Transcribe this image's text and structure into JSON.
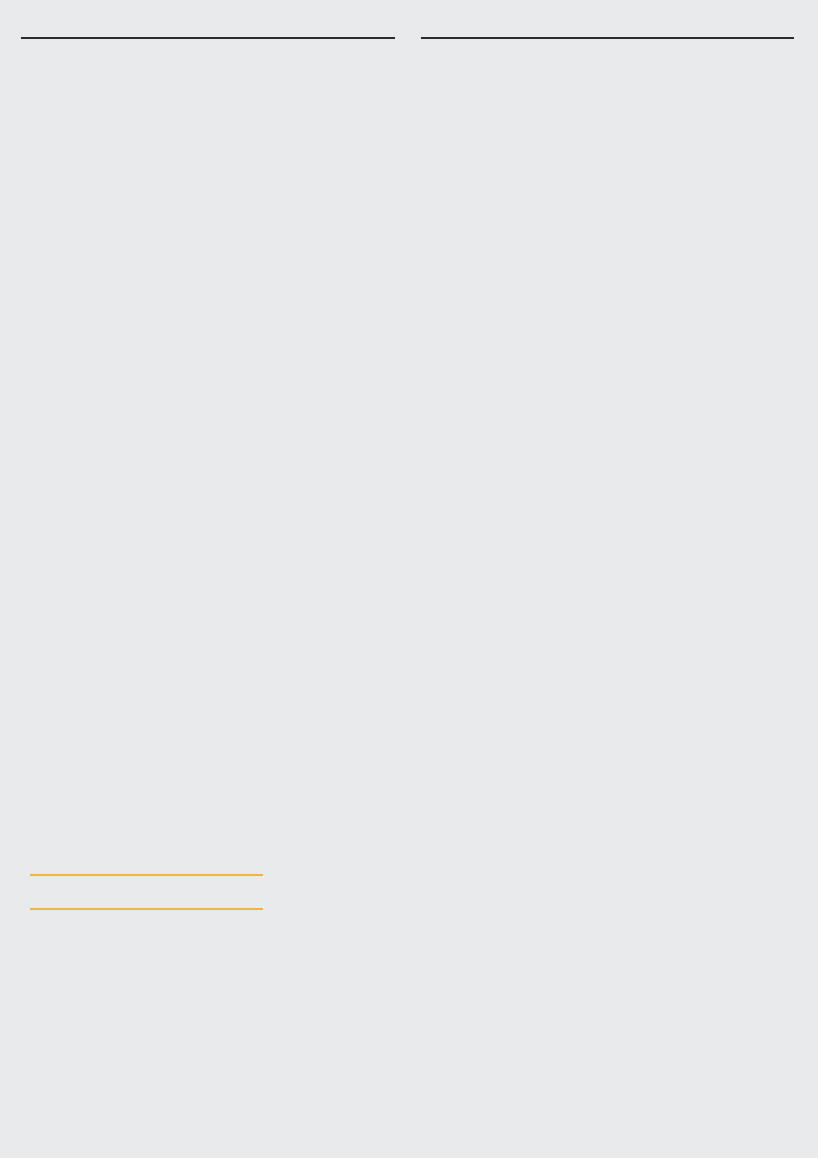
{
  "header": {
    "brand": "ROOF VAZISUBANI"
  },
  "title": "93.9 მ² რენდერი",
  "page_number": "03.",
  "areas": {
    "rooms": [
      "მისაღები ოთახი - 31.1 მ²",
      "საძინებელი 1  - 15.1 მ²",
      "საძინებელი 2  - 15.2 მ²",
      "სველი წერტილი - 6.9 მ²",
      "ჰოლი - 9.0 მ²"
    ],
    "balcony": [
      "აივანი 1 - 16.6 მ²"
    ],
    "totals": [
      "საცხოვრებელი ფართი - 77.3 მ²",
      "საერთო ფართი - 93.9 მ²"
    ]
  },
  "palette": {
    "accent": "#f2b43e",
    "headerLine": "#2c2c29",
    "text": "#1d1d1b",
    "bg": "#e9eaec",
    "wood": "#cf9a58",
    "woodLine": "#ad7a38",
    "wallTop": "#ffffff",
    "wallS": "#f7f0e4",
    "wallE": "#eee6d7",
    "outline": "#46423b",
    "tile": "#f3eee3",
    "tileLine": "#d9d2c1",
    "cabinet": "#c3b791",
    "cabinetHi": "#cfc49f",
    "counter": "#dcc8a4",
    "darkDoor": "#332d28",
    "darkWall": "#3d3a35",
    "glass": "#ccd6d4",
    "frame": "#55524d",
    "bed": "#f7f5ef",
    "blanket": "#d6cec0",
    "pillow": "#cfc3a0",
    "sofa": "#e4dfd4",
    "bath": "#ebe4dc",
    "plant": "#6d8c58",
    "plantDark": "#4e6f42",
    "terracotta": "#c67e52",
    "rattan": "#ad6f35",
    "glow": "#ffbe7e",
    "planLine": "#8f8f8f",
    "planDark": "#6a6a6a",
    "planFill": "#f3f2ef",
    "planYellow": "#f6c73e"
  }
}
